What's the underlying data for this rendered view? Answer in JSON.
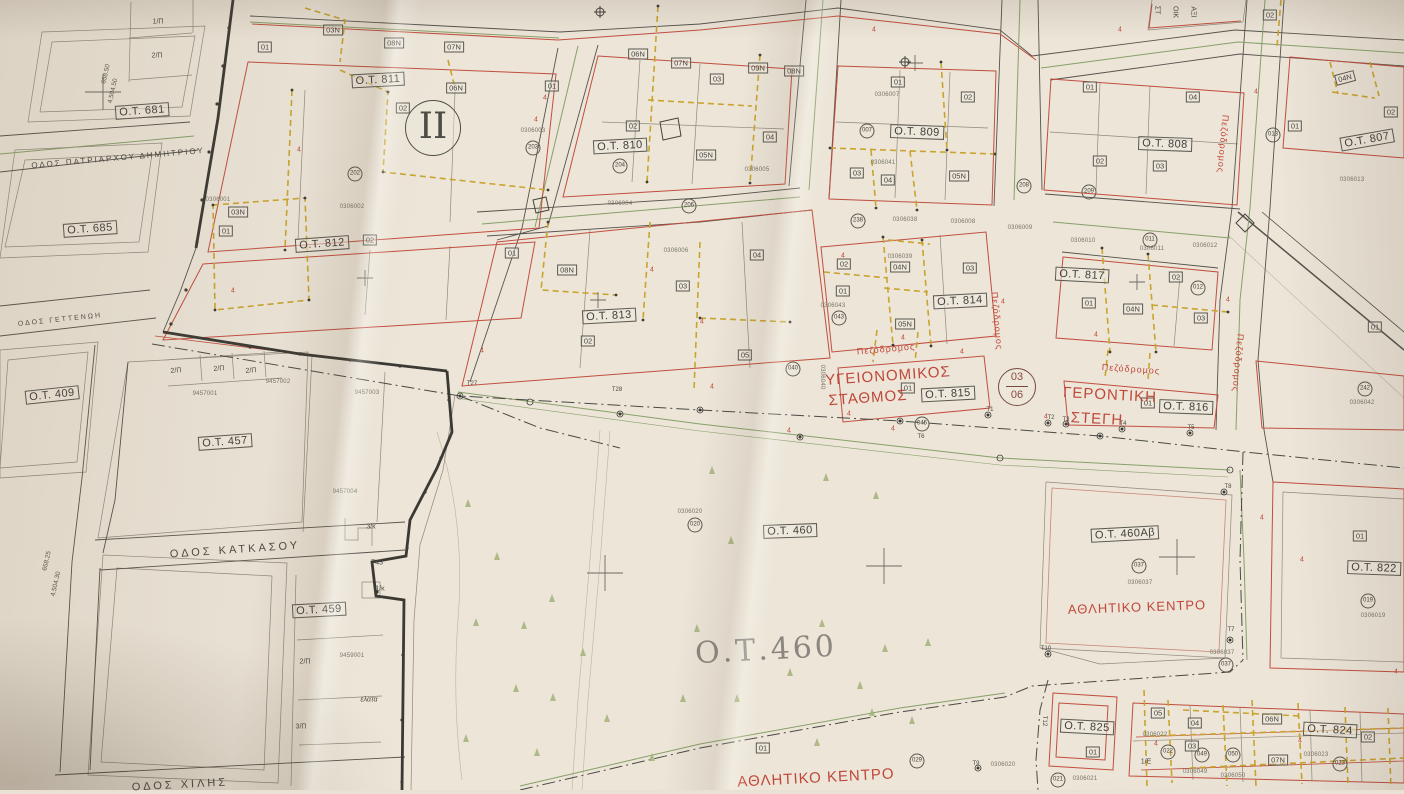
{
  "map": {
    "section_marker": "II",
    "sheet_ref": {
      "top": "03",
      "bottom": "06"
    },
    "big_label": {
      "t": "Ο.Τ.460",
      "x": 766,
      "y": 650,
      "r": -3
    },
    "palette": {
      "red_line": "#c14e3f",
      "yellow_dash": "#c9a42e",
      "green_line": "#87a06a",
      "red_text": "#c0483a",
      "ink": "#55534c"
    },
    "blocks": [
      {
        "t": "Ο.Τ. 811",
        "x": 378,
        "y": 80,
        "r": -3
      },
      {
        "t": "Ο.Τ. 810",
        "x": 620,
        "y": 146,
        "r": -3
      },
      {
        "t": "Ο.Τ. 812",
        "x": 322,
        "y": 244,
        "r": -4
      },
      {
        "t": "Ο.Τ. 813",
        "x": 609,
        "y": 316,
        "r": -3
      },
      {
        "t": "Ο.Τ. 809",
        "x": 917,
        "y": 132,
        "r": 2
      },
      {
        "t": "Ο.Τ. 808",
        "x": 1165,
        "y": 144,
        "r": 2
      },
      {
        "t": "Ο.Τ. 807",
        "x": 1367,
        "y": 140,
        "r": -10
      },
      {
        "t": "Ο.Τ. 814",
        "x": 960,
        "y": 301,
        "r": -3
      },
      {
        "t": "Ο.Τ. 815",
        "x": 948,
        "y": 394,
        "r": -3
      },
      {
        "t": "Ο.Τ. 816",
        "x": 1186,
        "y": 407,
        "r": 2
      },
      {
        "t": "Ο.Τ. 817",
        "x": 1082,
        "y": 275,
        "r": 3
      },
      {
        "t": "Ο.Τ. 822",
        "x": 1374,
        "y": 568,
        "r": 2
      },
      {
        "t": "Ο.Τ. 824",
        "x": 1330,
        "y": 730,
        "r": 3
      },
      {
        "t": "Ο.Τ. 825",
        "x": 1087,
        "y": 727,
        "r": 3
      },
      {
        "t": "Ο.Τ. 460",
        "x": 790,
        "y": 531,
        "r": -2
      },
      {
        "t": "Ο.Τ. 460Αβ",
        "x": 1125,
        "y": 534,
        "r": -3
      },
      {
        "t": "Ο.Τ. 681",
        "x": 142,
        "y": 111,
        "r": -4
      },
      {
        "t": "Ο.Τ. 685",
        "x": 90,
        "y": 229,
        "r": -4
      },
      {
        "t": "Ο.Τ. 409",
        "x": 52,
        "y": 395,
        "r": -6
      },
      {
        "t": "Ο.Τ. 457",
        "x": 225,
        "y": 442,
        "r": -4
      },
      {
        "t": "Ο.Τ. 459",
        "x": 319,
        "y": 610,
        "r": -3
      }
    ],
    "red_labels": [
      {
        "t": "ΥΓΕΙΟΝΟΜΙΚΟΣ",
        "x": 888,
        "y": 376,
        "r": -4,
        "s": 15
      },
      {
        "t": "ΣΤΑΘΜΟΣ",
        "x": 868,
        "y": 398,
        "r": -4,
        "s": 15
      },
      {
        "t": "ΓΕΡΟΝΤΙΚΗ",
        "x": 1110,
        "y": 395,
        "r": 3,
        "s": 15
      },
      {
        "t": "ΣΤΕΓΗ",
        "x": 1097,
        "y": 419,
        "r": 3,
        "s": 15
      },
      {
        "t": "ΑΘΛΗΤΙΚΟ ΚΕΝΤΡΟ",
        "x": 1137,
        "y": 607,
        "r": -2,
        "s": 13
      },
      {
        "t": "ΑΘΛΗΤΙΚΟ ΚΕΝΤΡΟ",
        "x": 816,
        "y": 778,
        "r": -3,
        "s": 15
      },
      {
        "t": "Πεζόδρομος",
        "x": 886,
        "y": 349,
        "r": -5,
        "s": 9
      },
      {
        "t": "Πεζόδρομος",
        "x": 1131,
        "y": 369,
        "r": 4,
        "s": 9
      },
      {
        "t": "Πεζόδρομος",
        "x": 997,
        "y": 321,
        "r": 85,
        "s": 9
      },
      {
        "t": "Πεζόδρομος",
        "x": 1238,
        "y": 363,
        "r": 95,
        "s": 9
      },
      {
        "t": "Πεζόδρομος",
        "x": 1223,
        "y": 144,
        "r": 95,
        "s": 9
      }
    ],
    "streets": [
      {
        "t": "ΟΔΟΣ ΠΑΤΡΙΑΡΧΟΥ ΔΗΜΗΤΡΙΟΥ",
        "x": 118,
        "y": 158,
        "r": -5,
        "s": 8,
        "ls": 2
      },
      {
        "t": "ΟΔΟΣ ΓΕΤΤΕΝΩΗ",
        "x": 60,
        "y": 320,
        "r": -6,
        "s": 7,
        "ls": 2
      },
      {
        "t": "ΟΔΟΣ ΚΑΤΚΑΣΟΥ",
        "x": 235,
        "y": 550,
        "r": -4,
        "s": 11,
        "ls": 3
      },
      {
        "t": "ΟΔΟΣ ΧΙΛΗΣ",
        "x": 180,
        "y": 785,
        "r": -3,
        "s": 11,
        "ls": 3
      }
    ],
    "parcel_tags": [
      {
        "t": "01",
        "x": 265,
        "y": 47
      },
      {
        "t": "03N",
        "x": 333,
        "y": 30
      },
      {
        "t": "08N",
        "x": 394,
        "y": 43
      },
      {
        "t": "07N",
        "x": 454,
        "y": 47
      },
      {
        "t": "06N",
        "x": 456,
        "y": 88
      },
      {
        "t": "02",
        "x": 403,
        "y": 108
      },
      {
        "t": "01",
        "x": 552,
        "y": 86
      },
      {
        "t": "02",
        "x": 370,
        "y": 240
      },
      {
        "t": "03N",
        "x": 238,
        "y": 212
      },
      {
        "t": "01",
        "x": 226,
        "y": 231
      },
      {
        "t": "06N",
        "x": 638,
        "y": 54
      },
      {
        "t": "07N",
        "x": 681,
        "y": 63
      },
      {
        "t": "03",
        "x": 717,
        "y": 79
      },
      {
        "t": "09N",
        "x": 758,
        "y": 68
      },
      {
        "t": "08N",
        "x": 794,
        "y": 71
      },
      {
        "t": "02",
        "x": 633,
        "y": 126
      },
      {
        "t": "04",
        "x": 770,
        "y": 137
      },
      {
        "t": "05N",
        "x": 706,
        "y": 155
      },
      {
        "t": "01",
        "x": 512,
        "y": 253
      },
      {
        "t": "08N",
        "x": 567,
        "y": 270
      },
      {
        "t": "02",
        "x": 588,
        "y": 341
      },
      {
        "t": "03",
        "x": 683,
        "y": 286
      },
      {
        "t": "04",
        "x": 757,
        "y": 255
      },
      {
        "t": "05",
        "x": 745,
        "y": 355
      },
      {
        "t": "02",
        "x": 844,
        "y": 264
      },
      {
        "t": "01",
        "x": 843,
        "y": 291
      },
      {
        "t": "04N",
        "x": 900,
        "y": 267
      },
      {
        "t": "03",
        "x": 970,
        "y": 268
      },
      {
        "t": "05N",
        "x": 905,
        "y": 324
      },
      {
        "t": "01",
        "x": 898,
        "y": 82
      },
      {
        "t": "02",
        "x": 968,
        "y": 97
      },
      {
        "t": "03",
        "x": 857,
        "y": 173
      },
      {
        "t": "04",
        "x": 888,
        "y": 180
      },
      {
        "t": "05N",
        "x": 959,
        "y": 176
      },
      {
        "t": "01",
        "x": 1090,
        "y": 87
      },
      {
        "t": "04",
        "x": 1193,
        "y": 97
      },
      {
        "t": "02",
        "x": 1100,
        "y": 161
      },
      {
        "t": "03",
        "x": 1160,
        "y": 166
      },
      {
        "t": "02",
        "x": 1270,
        "y": 15
      },
      {
        "t": "04N",
        "x": 1345,
        "y": 78,
        "r": -15
      },
      {
        "t": "02",
        "x": 1391,
        "y": 112
      },
      {
        "t": "01",
        "x": 1295,
        "y": 126
      },
      {
        "t": "01",
        "x": 1089,
        "y": 303
      },
      {
        "t": "04N",
        "x": 1133,
        "y": 309
      },
      {
        "t": "02",
        "x": 1176,
        "y": 277
      },
      {
        "t": "03",
        "x": 1201,
        "y": 318
      },
      {
        "t": "01",
        "x": 1375,
        "y": 327
      },
      {
        "t": "01",
        "x": 908,
        "y": 388
      },
      {
        "t": "01",
        "x": 1148,
        "y": 403
      },
      {
        "t": "01",
        "x": 1360,
        "y": 536
      },
      {
        "t": "01",
        "x": 763,
        "y": 748
      },
      {
        "t": "01",
        "x": 1093,
        "y": 752
      },
      {
        "t": "05",
        "x": 1158,
        "y": 713
      },
      {
        "t": "04",
        "x": 1195,
        "y": 723
      },
      {
        "t": "03",
        "x": 1192,
        "y": 746
      },
      {
        "t": "06N",
        "x": 1272,
        "y": 719
      },
      {
        "t": "07N",
        "x": 1278,
        "y": 760
      },
      {
        "t": "02",
        "x": 1368,
        "y": 737
      }
    ],
    "circled_refs": [
      {
        "t": "202",
        "x": 355,
        "y": 174
      },
      {
        "t": "203",
        "x": 533,
        "y": 148
      },
      {
        "t": "204",
        "x": 620,
        "y": 166
      },
      {
        "t": "206",
        "x": 689,
        "y": 206
      },
      {
        "t": "007",
        "x": 867,
        "y": 131
      },
      {
        "t": "208",
        "x": 1024,
        "y": 186
      },
      {
        "t": "209",
        "x": 1089,
        "y": 192
      },
      {
        "t": "011",
        "x": 1150,
        "y": 240
      },
      {
        "t": "012",
        "x": 1198,
        "y": 288
      },
      {
        "t": "013",
        "x": 1273,
        "y": 135
      },
      {
        "t": "040",
        "x": 793,
        "y": 369
      },
      {
        "t": "043",
        "x": 839,
        "y": 318
      },
      {
        "t": "045",
        "x": 922,
        "y": 424
      },
      {
        "t": "242",
        "x": 1365,
        "y": 389
      },
      {
        "t": "020",
        "x": 695,
        "y": 525
      },
      {
        "t": "029",
        "x": 917,
        "y": 761
      },
      {
        "t": "037",
        "x": 1139,
        "y": 566
      },
      {
        "t": "037",
        "x": 1226,
        "y": 665
      },
      {
        "t": "019",
        "x": 1368,
        "y": 601
      },
      {
        "t": "021",
        "x": 1058,
        "y": 780
      },
      {
        "t": "022",
        "x": 1168,
        "y": 752
      },
      {
        "t": "049",
        "x": 1202,
        "y": 755
      },
      {
        "t": "050",
        "x": 1233,
        "y": 755
      },
      {
        "t": "023",
        "x": 1340,
        "y": 764
      },
      {
        "t": "238",
        "x": 858,
        "y": 221
      }
    ],
    "survey_numbers": [
      {
        "t": "0306001",
        "x": 218,
        "y": 200
      },
      {
        "t": "0306002",
        "x": 352,
        "y": 207
      },
      {
        "t": "0306003",
        "x": 533,
        "y": 131
      },
      {
        "t": "0306004",
        "x": 620,
        "y": 204
      },
      {
        "t": "0306005",
        "x": 757,
        "y": 170
      },
      {
        "t": "0306006",
        "x": 676,
        "y": 251
      },
      {
        "t": "0306007",
        "x": 887,
        "y": 95
      },
      {
        "t": "0306008",
        "x": 963,
        "y": 222
      },
      {
        "t": "0306009",
        "x": 1020,
        "y": 228
      },
      {
        "t": "0306041",
        "x": 883,
        "y": 163
      },
      {
        "t": "0306038",
        "x": 905,
        "y": 220
      },
      {
        "t": "0306039",
        "x": 900,
        "y": 257
      },
      {
        "t": "0306043",
        "x": 833,
        "y": 306
      },
      {
        "t": "0306040",
        "x": 822,
        "y": 377,
        "r": 90
      },
      {
        "t": "0306010",
        "x": 1083,
        "y": 241
      },
      {
        "t": "0306011",
        "x": 1152,
        "y": 249
      },
      {
        "t": "0306012",
        "x": 1205,
        "y": 246
      },
      {
        "t": "0306013",
        "x": 1352,
        "y": 180
      },
      {
        "t": "0306042",
        "x": 1362,
        "y": 403
      },
      {
        "t": "0306020",
        "x": 690,
        "y": 512
      },
      {
        "t": "0306020",
        "x": 1003,
        "y": 765
      },
      {
        "t": "0306021",
        "x": 1085,
        "y": 779
      },
      {
        "t": "0306022",
        "x": 1155,
        "y": 735
      },
      {
        "t": "0306049",
        "x": 1195,
        "y": 772
      },
      {
        "t": "0306050",
        "x": 1233,
        "y": 776
      },
      {
        "t": "0306023",
        "x": 1316,
        "y": 755
      },
      {
        "t": "0306037",
        "x": 1140,
        "y": 583
      },
      {
        "t": "0306037",
        "x": 1222,
        "y": 653
      },
      {
        "t": "0306019",
        "x": 1373,
        "y": 616
      },
      {
        "t": "9457001",
        "x": 205,
        "y": 394
      },
      {
        "t": "9457002",
        "x": 278,
        "y": 382
      },
      {
        "t": "9457003",
        "x": 367,
        "y": 393
      },
      {
        "t": "9457004",
        "x": 345,
        "y": 492
      },
      {
        "t": "9459001",
        "x": 352,
        "y": 656
      }
    ],
    "misc_labels": [
      {
        "t": "1/Π",
        "x": 158,
        "y": 22
      },
      {
        "t": "2/Π",
        "x": 157,
        "y": 56
      },
      {
        "t": "2/Π",
        "x": 176,
        "y": 371,
        "r": -4
      },
      {
        "t": "2/Π",
        "x": 219,
        "y": 369,
        "r": -4
      },
      {
        "t": "2/Π",
        "x": 251,
        "y": 371,
        "r": -4
      },
      {
        "t": "3/κ",
        "x": 371,
        "y": 527
      },
      {
        "t": "Τ43",
        "x": 377,
        "y": 563
      },
      {
        "t": "1/κ",
        "x": 380,
        "y": 589
      },
      {
        "t": "ελατα",
        "x": 369,
        "y": 700,
        "i": 1
      },
      {
        "t": "2/Π",
        "x": 305,
        "y": 662
      },
      {
        "t": "3/Π",
        "x": 301,
        "y": 727
      },
      {
        "t": "1/Ε",
        "x": 1146,
        "y": 762
      },
      {
        "t": "Τ27",
        "x": 472,
        "y": 384,
        "s": 6
      },
      {
        "t": "Τ28",
        "x": 617,
        "y": 390,
        "s": 6
      },
      {
        "t": "Τ1",
        "x": 990,
        "y": 410,
        "s": 6
      },
      {
        "t": "Τ2",
        "x": 1051,
        "y": 418,
        "s": 6
      },
      {
        "t": "Τ3",
        "x": 1066,
        "y": 420,
        "s": 6
      },
      {
        "t": "Τ4",
        "x": 1123,
        "y": 424,
        "s": 6
      },
      {
        "t": "Τ5",
        "x": 1191,
        "y": 428,
        "s": 6
      },
      {
        "t": "Τ6",
        "x": 921,
        "y": 437,
        "s": 6
      },
      {
        "t": "Τ7",
        "x": 1231,
        "y": 630,
        "s": 6
      },
      {
        "t": "Τ8",
        "x": 1228,
        "y": 487,
        "s": 6
      },
      {
        "t": "Τ9",
        "x": 976,
        "y": 764,
        "s": 6
      },
      {
        "t": "Τ10",
        "x": 1046,
        "y": 649,
        "s": 6
      },
      {
        "t": "Τ12",
        "x": 1044,
        "y": 721,
        "r": 90,
        "s": 6
      },
      {
        "t": "ΣΤ",
        "x": 1157,
        "y": 10,
        "r": 90
      },
      {
        "t": "ΟΙΚ",
        "x": 1175,
        "y": 12,
        "r": 90
      },
      {
        "t": "ΑΞΙ",
        "x": 1193,
        "y": 12,
        "r": 90
      }
    ],
    "coord_labels": [
      {
        "t": "658.50",
        "x": 106,
        "y": 74,
        "r": -77
      },
      {
        "t": "4.504.50",
        "x": 113,
        "y": 91,
        "r": -77
      },
      {
        "t": "658.25",
        "x": 47,
        "y": 561,
        "r": -77
      },
      {
        "t": "4.504.30",
        "x": 56,
        "y": 584,
        "r": -77
      }
    ],
    "setback_marks": [
      {
        "t": "4",
        "x": 299,
        "y": 150
      },
      {
        "t": "4",
        "x": 545,
        "y": 98
      },
      {
        "t": "4",
        "x": 652,
        "y": 270
      },
      {
        "t": "4",
        "x": 702,
        "y": 322
      },
      {
        "t": "4",
        "x": 843,
        "y": 256
      },
      {
        "t": "4",
        "x": 903,
        "y": 338
      },
      {
        "t": "4",
        "x": 962,
        "y": 352
      },
      {
        "t": "4",
        "x": 1003,
        "y": 302
      },
      {
        "t": "4",
        "x": 1046,
        "y": 417
      },
      {
        "t": "4",
        "x": 1096,
        "y": 335
      },
      {
        "t": "4",
        "x": 1228,
        "y": 300
      },
      {
        "t": "4",
        "x": 1262,
        "y": 518
      },
      {
        "t": "4",
        "x": 1302,
        "y": 560
      },
      {
        "t": "4",
        "x": 1396,
        "y": 672
      },
      {
        "t": "4",
        "x": 1156,
        "y": 744
      },
      {
        "t": "4",
        "x": 1300,
        "y": 741
      },
      {
        "t": "4",
        "x": 893,
        "y": 429
      },
      {
        "t": "4",
        "x": 849,
        "y": 414
      },
      {
        "t": "4",
        "x": 789,
        "y": 431
      },
      {
        "t": "4",
        "x": 712,
        "y": 387
      },
      {
        "t": "4",
        "x": 482,
        "y": 351
      },
      {
        "t": "4",
        "x": 233,
        "y": 291
      },
      {
        "t": "4",
        "x": 536,
        "y": 120
      },
      {
        "t": "4",
        "x": 874,
        "y": 30
      },
      {
        "t": "4",
        "x": 1120,
        "y": 30
      },
      {
        "t": "4",
        "x": 1256,
        "y": 92
      }
    ],
    "trees": [
      {
        "x": 468,
        "y": 503
      },
      {
        "x": 497,
        "y": 556
      },
      {
        "x": 476,
        "y": 622
      },
      {
        "x": 516,
        "y": 688
      },
      {
        "x": 552,
        "y": 598
      },
      {
        "x": 583,
        "y": 652
      },
      {
        "x": 466,
        "y": 738
      },
      {
        "x": 537,
        "y": 752
      },
      {
        "x": 607,
        "y": 718
      },
      {
        "x": 652,
        "y": 757
      },
      {
        "x": 697,
        "y": 628
      },
      {
        "x": 737,
        "y": 698
      },
      {
        "x": 817,
        "y": 742
      },
      {
        "x": 872,
        "y": 712
      },
      {
        "x": 790,
        "y": 672
      },
      {
        "x": 822,
        "y": 623
      },
      {
        "x": 885,
        "y": 648
      },
      {
        "x": 928,
        "y": 642
      },
      {
        "x": 683,
        "y": 698
      },
      {
        "x": 553,
        "y": 697
      },
      {
        "x": 524,
        "y": 625
      },
      {
        "x": 860,
        "y": 685
      },
      {
        "x": 712,
        "y": 470
      },
      {
        "x": 826,
        "y": 477
      },
      {
        "x": 876,
        "y": 495
      },
      {
        "x": 731,
        "y": 540
      },
      {
        "x": 912,
        "y": 720
      }
    ]
  }
}
